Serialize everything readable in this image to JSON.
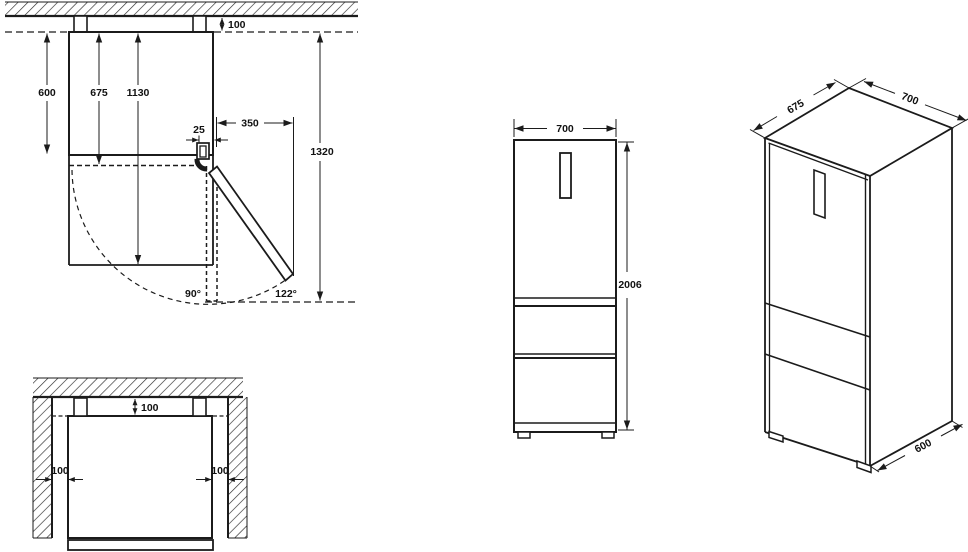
{
  "plan_view": {
    "top_clearance": "100",
    "cabinet_depth": "600",
    "door_depth": "675",
    "open_depth": "1130",
    "hinge_offset": "25",
    "door_projection": "350",
    "total_open_depth": "1320",
    "door_angle_90": "90°",
    "door_angle_max": "122°"
  },
  "niche_view": {
    "rear_clearance": "100",
    "left_clearance": "100",
    "right_clearance": "100"
  },
  "front_view": {
    "width": "700",
    "height": "2006"
  },
  "iso_view": {
    "depth_with_door": "675",
    "width": "700",
    "depth_body": "600"
  }
}
